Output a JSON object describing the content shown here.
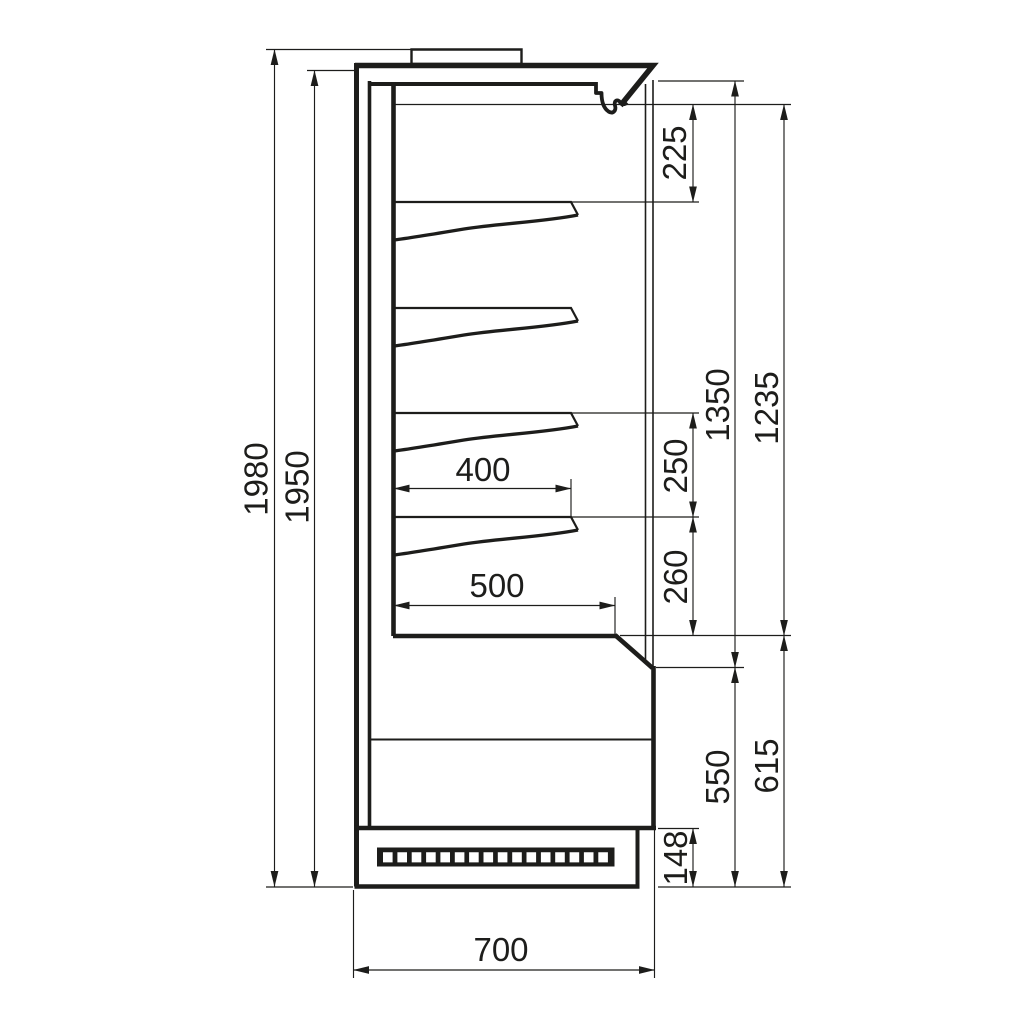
{
  "colors": {
    "ink": "#1d1d1b",
    "paper": "#ffffff"
  },
  "drawing": {
    "subject": "multideck-display-cabinet-side-section",
    "dims": {
      "overall_height": "1980",
      "body_height": "1950",
      "canopy_to_first_shelf": "225",
      "opening_height_outer": "1350",
      "opening_height_inner": "1235",
      "shelf_spacing_upper": "250",
      "shelf_spacing_lower": "260",
      "shelf_depth": "400",
      "well_depth": "500",
      "base_height_outer": "615",
      "base_height_inner": "550",
      "plinth_height": "148",
      "overall_depth": "700"
    }
  }
}
